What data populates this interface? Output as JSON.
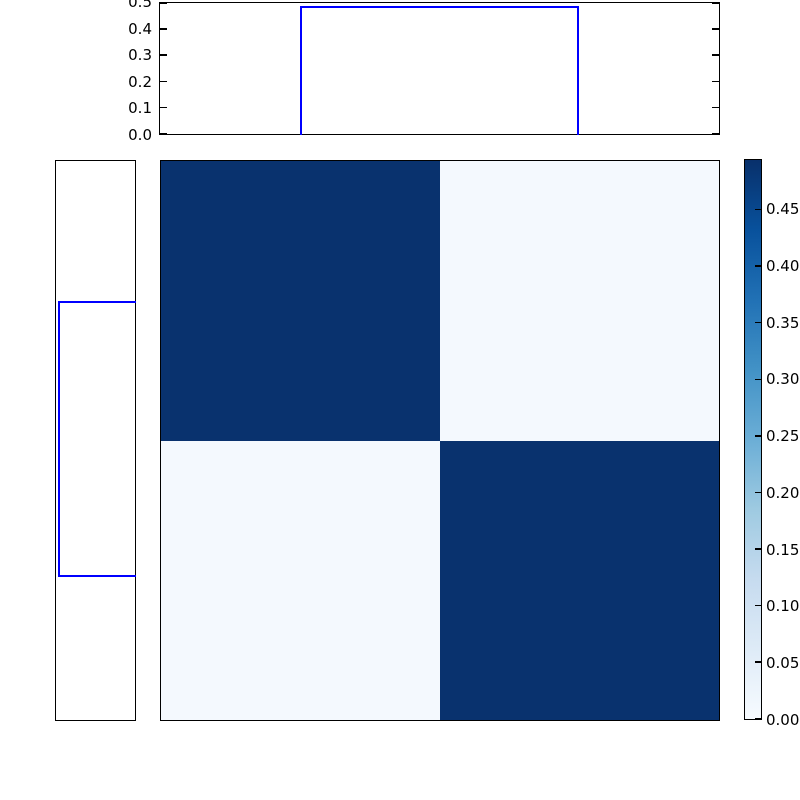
{
  "chart_data": {
    "type": "heatmap",
    "title": "",
    "description": "2x2 joint-distribution heatmap with step-function marginal densities on the top and left, and a Blues colorbar on the right",
    "heatmap": {
      "matrix": [
        [
          0.49,
          0.01
        ],
        [
          0.01,
          0.49
        ]
      ],
      "cell_colors": [
        [
          "#09326e",
          "#f4f9fe"
        ],
        [
          "#f4f9fe",
          "#09326e"
        ]
      ],
      "colormap": "Blues",
      "vmin": 0.0,
      "vmax": 0.494,
      "grid": false
    },
    "top_marginal": {
      "ylim": [
        0.0,
        0.5
      ],
      "ytick_labels": [
        "0.0",
        "0.1",
        "0.2",
        "0.3",
        "0.4",
        "0.5"
      ],
      "ytick_values": [
        0.0,
        0.1,
        0.2,
        0.3,
        0.4,
        0.5
      ],
      "step": {
        "start_frac": 0.25,
        "end_frac": 0.75,
        "value": 0.49
      },
      "line_color": "#0000ff"
    },
    "left_marginal": {
      "value_lim": [
        0.0,
        0.5
      ],
      "step": {
        "start_frac": 0.25,
        "end_frac": 0.745,
        "value": 0.49
      },
      "line_color": "#0000ff"
    },
    "colorbar": {
      "tick_labels": [
        "0.00",
        "0.05",
        "0.10",
        "0.15",
        "0.20",
        "0.25",
        "0.30",
        "0.35",
        "0.40",
        "0.45"
      ],
      "tick_values": [
        0.0,
        0.05,
        0.1,
        0.15,
        0.2,
        0.25,
        0.3,
        0.35,
        0.4,
        0.45
      ],
      "gradient_stops": [
        {
          "pos": 0.0,
          "color": "#f7fbff"
        },
        {
          "pos": 0.125,
          "color": "#deebf7"
        },
        {
          "pos": 0.25,
          "color": "#c6dbef"
        },
        {
          "pos": 0.375,
          "color": "#9ecae1"
        },
        {
          "pos": 0.5,
          "color": "#6baed6"
        },
        {
          "pos": 0.625,
          "color": "#4292c6"
        },
        {
          "pos": 0.75,
          "color": "#2171b5"
        },
        {
          "pos": 0.875,
          "color": "#08519c"
        },
        {
          "pos": 1.0,
          "color": "#08306b"
        }
      ]
    },
    "axes_color": "#000000",
    "background": "#ffffff"
  }
}
